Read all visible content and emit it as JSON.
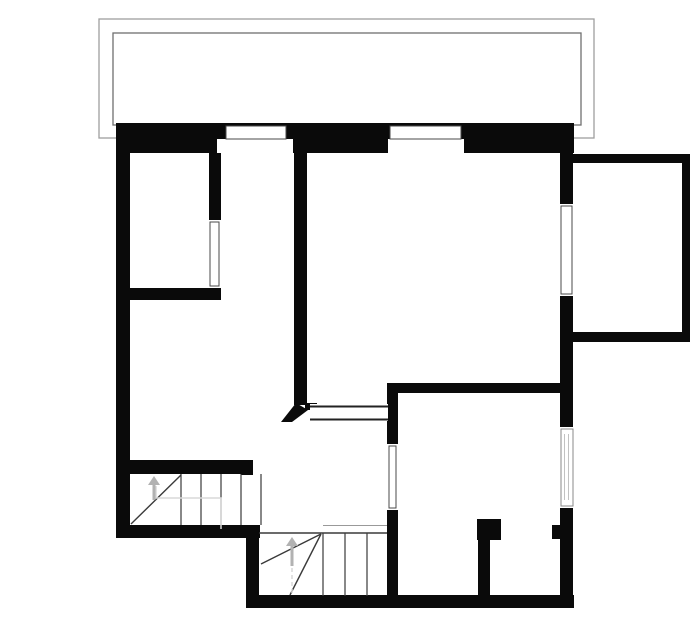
{
  "plan": {
    "canvas": {
      "width": 700,
      "height": 644,
      "background": "#ffffff"
    },
    "palette": {
      "wall": "#0a0a0a",
      "frame": "#4a4a4a",
      "frame_light": "#8a8a8a",
      "glaze": "#c2c2c2",
      "stair_line": "#3a3a3a",
      "stair_line_light": "#999999",
      "walk_line": "#d8d8d8",
      "arrow": "#b2b2b2",
      "balcony_outer": "#9e9e9e",
      "balcony_inner": "#6f6f6f",
      "opening_line": "#222222",
      "window_fill": "#ffffff"
    },
    "balcony_rails": [
      {
        "name": "balcony-outer-rail",
        "x": 99,
        "y": 19,
        "w": 495,
        "h": 119,
        "stroke": "balcony_outer"
      },
      {
        "name": "balcony-inner-rail",
        "x": 113,
        "y": 33,
        "w": 468,
        "h": 92,
        "stroke": "balcony_inner"
      }
    ],
    "walls": [
      {
        "name": "top-exterior-wall",
        "x": 116,
        "y": 123,
        "w": 458,
        "h": 30
      },
      {
        "name": "left-exterior-wall",
        "x": 116,
        "y": 123,
        "w": 14,
        "h": 415
      },
      {
        "name": "bottom-left-exterior-wall",
        "x": 116,
        "y": 525,
        "w": 144,
        "h": 13
      },
      {
        "name": "stair-annex-left-wall",
        "x": 246,
        "y": 525,
        "w": 13,
        "h": 83
      },
      {
        "name": "bottom-exterior-wall",
        "x": 246,
        "y": 595,
        "w": 328,
        "h": 13
      },
      {
        "name": "right-exterior-wall",
        "x": 560,
        "y": 153,
        "w": 13,
        "h": 455
      },
      {
        "name": "annex-top-wall",
        "x": 573,
        "y": 154,
        "w": 117,
        "h": 9
      },
      {
        "name": "annex-right-wall",
        "x": 682,
        "y": 154,
        "w": 8,
        "h": 188
      },
      {
        "name": "annex-bottom-wall",
        "x": 573,
        "y": 332,
        "w": 117,
        "h": 10
      },
      {
        "name": "bedroom-right-wall",
        "x": 209,
        "y": 153,
        "w": 12,
        "h": 68
      },
      {
        "name": "bedroom-bottom-wall",
        "x": 129,
        "y": 288,
        "w": 92,
        "h": 12
      },
      {
        "name": "hallway-partition-wall",
        "x": 294,
        "y": 123,
        "w": 13,
        "h": 282
      },
      {
        "name": "middle-partition-wall",
        "x": 388,
        "y": 383,
        "w": 185,
        "h": 10
      },
      {
        "name": "room-left-wall-upper",
        "x": 387,
        "y": 383,
        "w": 11,
        "h": 61
      },
      {
        "name": "room-left-wall-lower",
        "x": 387,
        "y": 510,
        "w": 11,
        "h": 88
      },
      {
        "name": "stairwell-top-wall",
        "x": 130,
        "y": 460,
        "w": 123,
        "h": 14
      },
      {
        "name": "stairwell-top-wall-step",
        "x": 241,
        "y": 460,
        "w": 12,
        "h": 15
      },
      {
        "name": "closet-door-pier",
        "x": 477,
        "y": 519,
        "w": 24,
        "h": 21
      },
      {
        "name": "closet-partition-wall",
        "x": 478,
        "y": 540,
        "w": 12,
        "h": 57
      },
      {
        "name": "right-wall-door-nub",
        "x": 552,
        "y": 525,
        "w": 8,
        "h": 14
      },
      {
        "name": "door-jamb-stub",
        "x": 305,
        "y": 403,
        "w": 12,
        "h": 7
      }
    ],
    "windows": [
      {
        "name": "window-top-1",
        "cut": [
          217,
          139,
          76,
          14
        ],
        "frame": [
          226,
          126,
          60,
          13
        ],
        "stroke": "frame"
      },
      {
        "name": "window-top-2",
        "cut": [
          388,
          139,
          76,
          14
        ],
        "frame": [
          390,
          126,
          71,
          13
        ],
        "stroke": "frame"
      },
      {
        "name": "window-right-upper",
        "cut": [
          560,
          204,
          13,
          92
        ],
        "frame": [
          561,
          206,
          11,
          88
        ],
        "stroke": "frame"
      },
      {
        "name": "window-right-lower",
        "cut": [
          560,
          427,
          13,
          81
        ],
        "frame": [
          561,
          429,
          12,
          77
        ],
        "stroke": "frame_light",
        "glaze": [
          [
            564.5,
            434,
            564.5,
            500
          ],
          [
            568.5,
            434,
            568.5,
            500
          ]
        ]
      },
      {
        "name": "door-bedroom",
        "cut": [
          209,
          220,
          12,
          68
        ],
        "frame": [
          210,
          222,
          9,
          64
        ],
        "stroke": "frame"
      },
      {
        "name": "door-lower-room",
        "cut": [
          387,
          444,
          11,
          66
        ],
        "frame": [
          389,
          446,
          7,
          62
        ],
        "stroke": "frame"
      }
    ],
    "opening": {
      "name": "hall-passage-opening",
      "rect": [
        310,
        404,
        78,
        17
      ],
      "lines": [
        [
          310,
          406.5,
          388,
          406.5
        ],
        [
          310,
          419.5,
          388,
          419.5
        ]
      ]
    },
    "door_leaf": {
      "name": "open-door-leaf",
      "points": "281,422 296,403 308,410 292,422"
    },
    "stairs": [
      {
        "name": "stairs-upper-flight",
        "treads": [
          [
            181,
            474,
            181,
            525
          ],
          [
            201,
            474,
            201,
            525
          ],
          [
            221,
            474,
            221,
            525
          ],
          [
            241,
            474,
            241,
            525
          ],
          [
            261,
            474,
            261,
            525
          ]
        ],
        "diagonals": [
          [
            131,
            524,
            181,
            475
          ]
        ],
        "edges": [],
        "arrow": {
          "tip": [
            154,
            476
          ],
          "tail": [
            154,
            500
          ]
        },
        "walkline": {
          "points": "156,486 156,498 221,498 221,529",
          "dash": false
        }
      },
      {
        "name": "stairs-lower-flight",
        "treads": [
          [
            323,
            533,
            323,
            596
          ],
          [
            345,
            533,
            345,
            596
          ],
          [
            367,
            533,
            367,
            596
          ]
        ],
        "diagonals": [
          [
            321,
            534,
            261,
            564
          ],
          [
            321,
            534,
            290,
            595
          ]
        ],
        "edges": [
          {
            "line": [
              259,
              533,
              387,
              533
            ],
            "stroke": "stair_line",
            "w": 1.5
          },
          {
            "line": [
              323,
              525.5,
              387,
              525.5
            ],
            "stroke": "stair_line_light",
            "w": 1
          }
        ],
        "arrow": {
          "tip": [
            292,
            537
          ],
          "tail": [
            292,
            566
          ]
        },
        "walkline": {
          "points": "292,568 292,594",
          "dash": true
        }
      }
    ]
  }
}
